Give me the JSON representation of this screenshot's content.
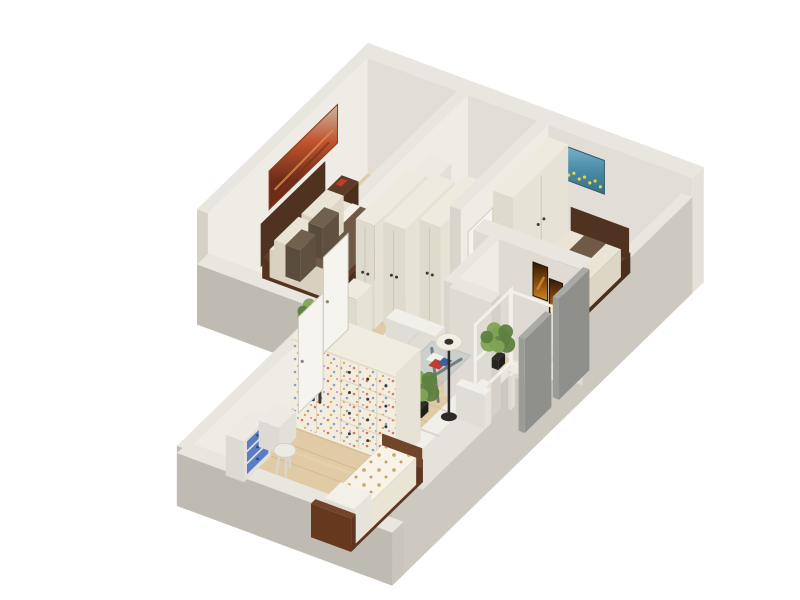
{
  "title": "3D isometric floor plan render of a two-bedroom apartment",
  "background": "#ffffff",
  "palette": {
    "wall_top": "#e9e6df",
    "wall_inner_bright": "#efece5",
    "wall_inner_mid": "#dfdbd3",
    "wall_inner_shade": "#d9d5cd",
    "wall_outer_gray": "#bfbbb2",
    "wall_outer_light": "#cdc9c1",
    "wall_end": "#d5d1c9",
    "floor_wood": "#e0cba6",
    "floor_wood_light": "#ecdbbc",
    "floor_line": "#c2a377",
    "bath_tile": "#8fb3d2",
    "bath_tile_dark": "#6e96bd",
    "bath_tile_light": "#aac6dd",
    "tub_white": "#f3f3f0",
    "tub_inner": "#d9dcdb",
    "glass": "#b9c6ca",
    "bed_wood_dark": "#5d3b24",
    "bed_wood_red": "#71452a",
    "headboard_dark": "#4f3220",
    "bedding_cream": "#eae4d4",
    "bedding_white": "#f3f0e7",
    "blanket_brown": "#6f5a47",
    "pillow_brown": "#70604e",
    "kid_mattress": "#f7f3e8",
    "kid_print_tan": "#c8a45f",
    "sofa_white": "#f1efe9",
    "sofa_shadow": "#d8d6d0",
    "closet_cream_top": "#eeeae0",
    "closet_cream_east": "#e6e2d6",
    "closet_cream_south": "#dedacc",
    "confetti_base": "#f3edde",
    "handle_dark": "#3c3833",
    "door_white": "#f6f4ee",
    "door_edge": "#cfccc2",
    "dresser_blue": "#5b7cc4",
    "white_furniture": "#eceae2",
    "lamp_black": "#2c2a27",
    "lamp_shade": "#f1ede2",
    "plant_green": "#5e8040",
    "plant_green2": "#7fa455",
    "pot_dark": "#2f2d29",
    "panel_gray": "#9b9b98",
    "panel_gray_dark": "#8f8f8c",
    "art_master_top": "#c9b8a5",
    "art_master_red": "#c1552f",
    "art_master_dark": "#6e2d18",
    "art_bed2_light": "#7ab3c9",
    "art_bed2_mid": "#4b8ba6",
    "art_bed2_deep": "#39707f",
    "art_flower_yellow": "#e8d24a",
    "art_hall_dark": "#2e1a06",
    "art_hall_mid": "#8a4d10",
    "art_hall_orange": "#d08a24",
    "magazine_red": "#c03b30",
    "magazine_blue": "#3b5fa0",
    "table_glass_leg": "#6e7678"
  },
  "scene": {
    "rooms": [
      {
        "name": "master-bedroom",
        "furniture": [
          "double-bed",
          "dark-headboard",
          "nightstand",
          "wall-art-abstract-red",
          "plant",
          "white-cabinet"
        ]
      },
      {
        "name": "bathroom",
        "furniture": [
          "bathtub",
          "glass-shower",
          "blue-mosaic-floor",
          "shower-column"
        ]
      },
      {
        "name": "closet-hall",
        "furniture": [
          "tall-closet-1",
          "tall-closet-2",
          "tall-closet-3",
          "low-cabinet",
          "open-door-master",
          "open-door-kids"
        ]
      },
      {
        "name": "second-bedroom",
        "furniture": [
          "double-bed",
          "wardrobe",
          "wall-art-flower-field",
          "plant",
          "open-door"
        ]
      },
      {
        "name": "entry-nook",
        "furniture": [
          "white-frame-shelves",
          "white-desk",
          "wall-art-orange-diptych",
          "plant",
          "gray-wall-panels"
        ]
      },
      {
        "name": "living-room",
        "furniture": [
          "lounge-sofa",
          "sectional-sofa",
          "glass-coffee-table",
          "magazines",
          "floor-lamp",
          "plant"
        ]
      },
      {
        "name": "kids-room",
        "furniture": [
          "single-bed-patterned",
          "patterned-wardrobe-dresser",
          "blue-dresser",
          "side-table",
          "stool"
        ]
      }
    ]
  }
}
